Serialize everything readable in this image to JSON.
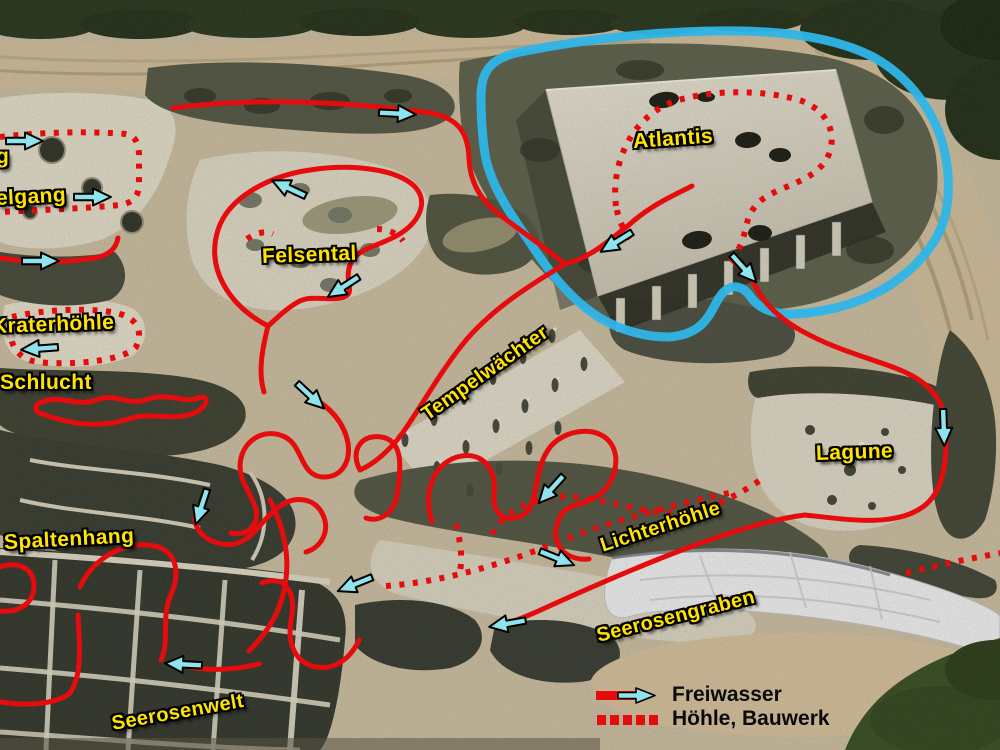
{
  "map": {
    "description": "Aerial construction-site map with marked visitor water routes",
    "region_labels": [
      {
        "id": "cut-left-1",
        "text": "g"
      },
      {
        "id": "cut-left-2",
        "text": "elgang"
      },
      {
        "id": "felsental",
        "text": "Felsental"
      },
      {
        "id": "kraterhoehle",
        "text": "Kraterhöhle"
      },
      {
        "id": "schlucht",
        "text": "Schlucht"
      },
      {
        "id": "tempelwaechter",
        "text": "Tempelwächter"
      },
      {
        "id": "atlantis",
        "text": "Atlantis"
      },
      {
        "id": "lagune",
        "text": "Lagune"
      },
      {
        "id": "spaltenhang",
        "text": "Spaltenhang"
      },
      {
        "id": "lichterhoehle",
        "text": "Lichterhöhle"
      },
      {
        "id": "seerosengraben",
        "text": "Seerosengraben"
      },
      {
        "id": "seerosenwelt",
        "text": "Seerosenwelt"
      }
    ],
    "legend": {
      "items": [
        {
          "symbol": "solid-red-line-with-cyan-arrow",
          "label": "Freiwasser"
        },
        {
          "symbol": "dotted-red-line",
          "label": "Höhle, Bauwerk"
        }
      ]
    },
    "icons": {
      "flow_arrow": "cyan-right-arrow"
    },
    "colors": {
      "route_red": "#e60b0c",
      "arrow_cyan": "#8fe3ec",
      "highlight_blue": "#2eb5e8",
      "label_yellow": "#ffe400",
      "legend_text": "#0a0a0a"
    }
  }
}
